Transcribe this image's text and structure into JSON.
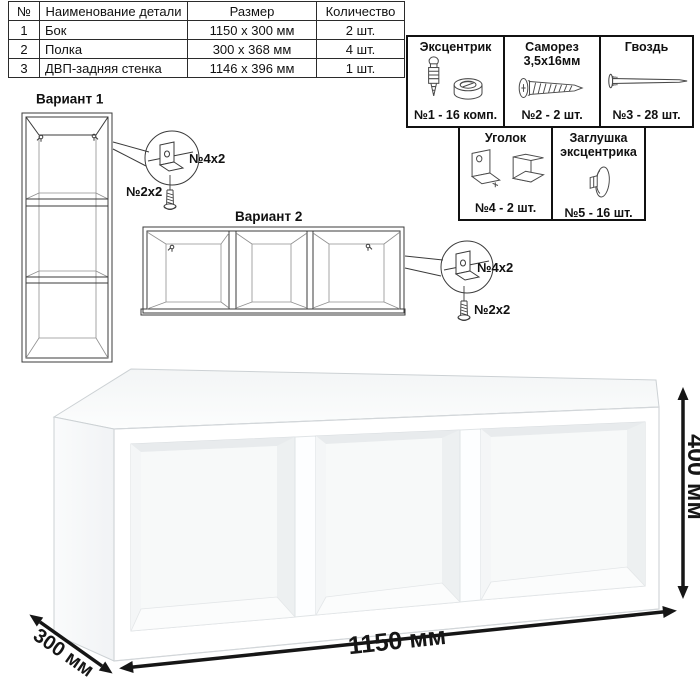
{
  "parts_table": {
    "headers": [
      "№",
      "Наименование детали",
      "Размер",
      "Количество"
    ],
    "rows": [
      [
        "1",
        "Бок",
        "1150 х 300 мм",
        "2 шт."
      ],
      [
        "2",
        "Полка",
        "300 х 368 мм",
        "4 шт."
      ],
      [
        "3",
        "ДВП-задняя стенка",
        "1146 х 396 мм",
        "1 шт."
      ]
    ]
  },
  "hardware_box": {
    "items": [
      {
        "title": "Эксцентрик",
        "subtitle": "",
        "count": "№1 - 16 комп.",
        "icon": "eccentric-cam-icon"
      },
      {
        "title": "Саморез",
        "subtitle": "3,5х16мм",
        "count": "№2 - 2 шт.",
        "icon": "screw-icon"
      },
      {
        "title": "Гвоздь",
        "subtitle": "",
        "count": "№3 - 28 шт.",
        "icon": "nail-icon"
      },
      {
        "title": "Уголок",
        "subtitle": "",
        "count": "№4 - 2 шт.",
        "icon": "corner-bracket-icon"
      },
      {
        "title": "Заглушка",
        "subtitle": "эксцентрика",
        "count": "№5 - 16 шт.",
        "icon": "cam-cap-icon"
      }
    ]
  },
  "variant1": {
    "label": "Вариант 1",
    "callout": {
      "bracket_label": "№4х2",
      "screw_label": "№2х2"
    }
  },
  "variant2": {
    "label": "Вариант 2",
    "callout": {
      "bracket_label": "№4х2",
      "screw_label": "№2х2"
    }
  },
  "dimensions": {
    "width_label": "1150 мм",
    "depth_label": "300 мм",
    "height_label": "400 мм"
  },
  "colors": {
    "outline": "#1a1a1a",
    "wireframe": "#3b3b3b",
    "render_edge": "#d2d6d9",
    "background": "#ffffff"
  }
}
